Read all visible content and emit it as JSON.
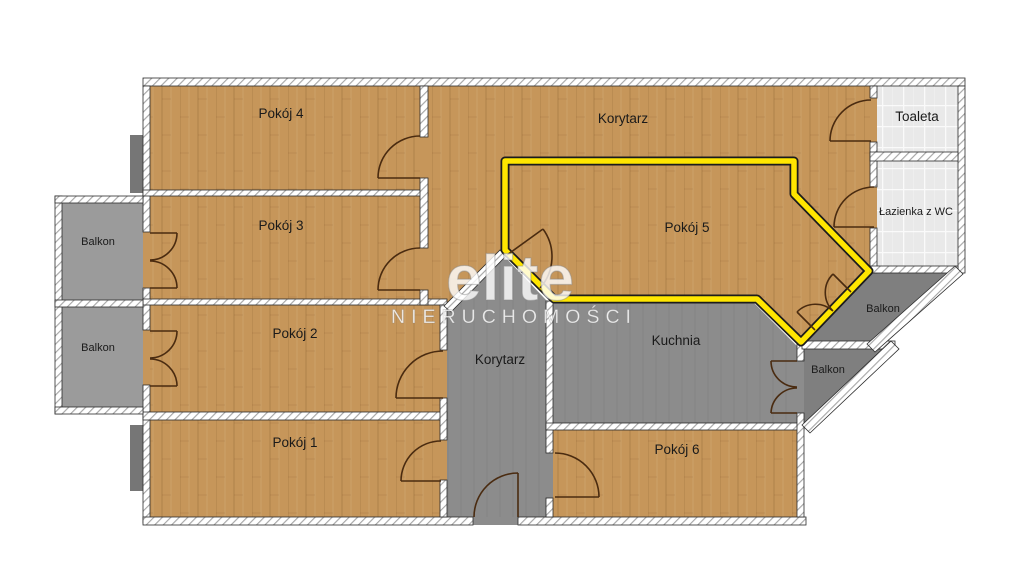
{
  "plan": {
    "labels": {
      "pokoj1": "Pokój 1",
      "pokoj2": "Pokój 2",
      "pokoj3": "Pokój 3",
      "pokoj4": "Pokój 4",
      "pokoj5": "Pokój 5",
      "pokoj6": "Pokój 6",
      "korytarz_top": "Korytarz",
      "korytarz_lower": "Korytarz",
      "kuchnia": "Kuchnia",
      "toaleta": "Toaleta",
      "lazienka": "Łazienka z WC",
      "balkon_left_upper": "Balkon",
      "balkon_left_lower": "Balkon",
      "balkon_right_upper": "Balkon",
      "balkon_right_lower": "Balkon"
    },
    "watermark": {
      "brand": "elite",
      "subtitle": "NIERUCHOMOŚCI"
    },
    "colors": {
      "wood_floor": "#C6965A",
      "corridor_gray": "#8C8C8C",
      "balcony_left_gray": "#9B9B9B",
      "balcony_right_gray": "#7F7F7F",
      "bathroom_tile": "#E9E9E9",
      "highlight_yellow": "#FFE600",
      "wall_white": "#FFFFFF",
      "door_arc_brown": "#4A2B10"
    }
  }
}
